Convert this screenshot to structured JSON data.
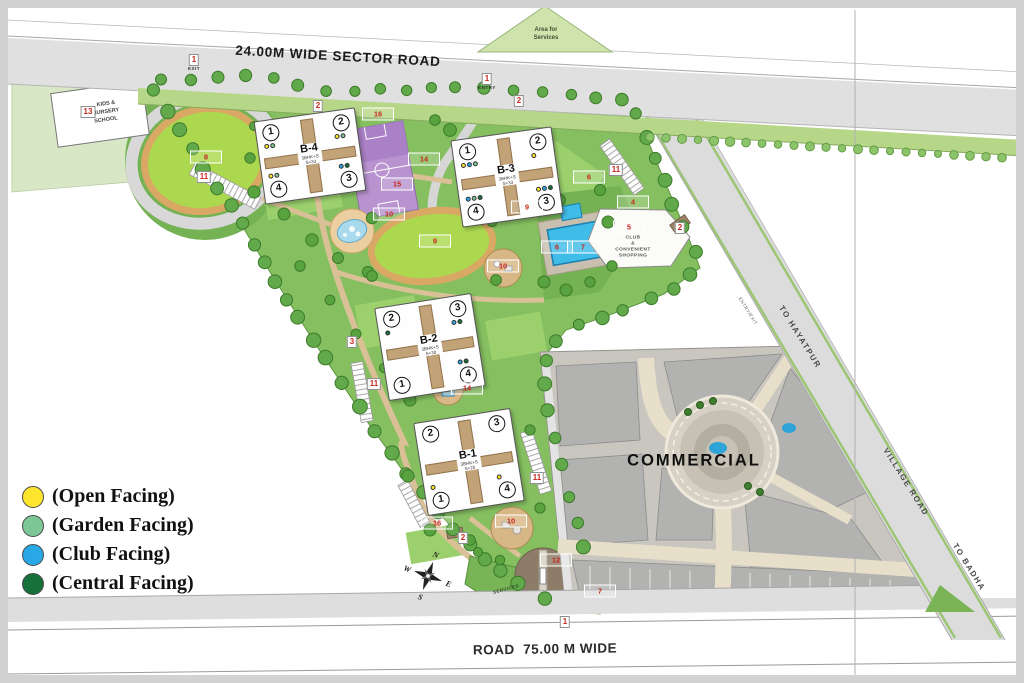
{
  "map": {
    "sector_road_label": "24.00M WIDE SECTOR ROAD",
    "bottom_road_label": "ROAD  75.00 M WIDE",
    "roads": {
      "to_hayatpur": "TO HAYATPUR",
      "village_road": "VILLAGE ROAD",
      "to_badha": "TO BADHA",
      "entry_exit": "ENTRY/EXIT"
    },
    "areas": {
      "commercial": "COMMERCIAL",
      "services_triangle": [
        "Area for",
        "Services"
      ],
      "services_patch": "SERVICES",
      "club": [
        "CLUB",
        "&",
        "CONVENIENT",
        "SHOPPING"
      ],
      "nursery": [
        "KIDS &",
        "NURSERY",
        "SCHOOL"
      ]
    },
    "compass": {
      "n": "N",
      "e": "E",
      "s": "S",
      "w": "W"
    },
    "legend_colors": {
      "open": "#ffe42e",
      "garden": "#7dc695",
      "club": "#29a8e6",
      "central": "#15703a"
    },
    "legend": {
      "items": [
        {
          "key": "open",
          "label": "(Open Facing)"
        },
        {
          "key": "garden",
          "label": "(Garden Facing)"
        },
        {
          "key": "club",
          "label": "(Club Facing)"
        },
        {
          "key": "central",
          "label": "(Central Facing)"
        }
      ]
    },
    "buildings": [
      {
        "name": "B-4",
        "sub1": "3BHK+S",
        "sub2": "S+33",
        "x": 310,
        "y": 156,
        "w": 100,
        "h": 82,
        "rot": -8,
        "towers": {
          "tl": {
            "n": "1",
            "dots": [
              "open",
              "garden"
            ]
          },
          "tr": {
            "n": "2",
            "dots": [
              "open",
              "garden"
            ]
          },
          "bl": {
            "n": "4",
            "dots": [
              "open",
              "garden"
            ]
          },
          "br": {
            "n": "3",
            "dots": [
              "club",
              "central"
            ]
          }
        }
      },
      {
        "name": "B-3",
        "sub1": "3BHK+S",
        "sub2": "S+33",
        "x": 507,
        "y": 177,
        "w": 100,
        "h": 86,
        "rot": -8,
        "towers": {
          "tl": {
            "n": "1",
            "dots": [
              "open",
              "club",
              "garden"
            ]
          },
          "tr": {
            "n": "2",
            "dots": [
              "open"
            ]
          },
          "bl": {
            "n": "4",
            "dots": [
              "club",
              "garden",
              "central"
            ]
          },
          "br": {
            "n": "3",
            "dots": [
              "open",
              "club",
              "central"
            ]
          }
        }
      },
      {
        "name": "B-2",
        "sub1": "3BHK+S",
        "sub2": "S+30",
        "x": 430,
        "y": 347,
        "w": 96,
        "h": 92,
        "rot": -9,
        "towers": {
          "tl": {
            "n": "2",
            "dots": [
              "central"
            ]
          },
          "tr": {
            "n": "3",
            "dots": [
              "club",
              "central"
            ]
          },
          "bl": {
            "n": "1",
            "dots": []
          },
          "br": {
            "n": "4",
            "dots": [
              "club",
              "central"
            ]
          }
        }
      },
      {
        "name": "B-1",
        "sub1": "3BHK+S",
        "sub2": "S+20",
        "x": 469,
        "y": 462,
        "w": 96,
        "h": 92,
        "rot": -9,
        "towers": {
          "tl": {
            "n": "2",
            "dots": []
          },
          "tr": {
            "n": "3",
            "dots": []
          },
          "bl": {
            "n": "1",
            "dots": [
              "open"
            ]
          },
          "br": {
            "n": "4",
            "dots": [
              "open"
            ]
          }
        }
      }
    ],
    "markers": [
      {
        "n": "1",
        "x": 194,
        "y": 60,
        "caption": "EXIT"
      },
      {
        "n": "1",
        "x": 487,
        "y": 79,
        "caption": "ENTRY"
      },
      {
        "n": "1",
        "x": 565,
        "y": 622
      },
      {
        "n": "2",
        "x": 318,
        "y": 106
      },
      {
        "n": "2",
        "x": 519,
        "y": 101
      },
      {
        "n": "2",
        "x": 680,
        "y": 228
      },
      {
        "n": "2",
        "x": 463,
        "y": 538
      },
      {
        "n": "3",
        "x": 352,
        "y": 342
      },
      {
        "n": "4",
        "x": 633,
        "y": 202
      },
      {
        "n": "5",
        "x": 629,
        "y": 227
      },
      {
        "n": "6",
        "x": 589,
        "y": 177
      },
      {
        "n": "6",
        "x": 557,
        "y": 247
      },
      {
        "n": "7",
        "x": 583,
        "y": 247
      },
      {
        "n": "7",
        "x": 600,
        "y": 591
      },
      {
        "n": "8",
        "x": 206,
        "y": 157
      },
      {
        "n": "9",
        "x": 435,
        "y": 241
      },
      {
        "n": "9",
        "x": 527,
        "y": 207
      },
      {
        "n": "10",
        "x": 389,
        "y": 214
      },
      {
        "n": "10",
        "x": 503,
        "y": 266
      },
      {
        "n": "10",
        "x": 511,
        "y": 521
      },
      {
        "n": "11",
        "x": 204,
        "y": 177
      },
      {
        "n": "11",
        "x": 616,
        "y": 170
      },
      {
        "n": "11",
        "x": 374,
        "y": 384
      },
      {
        "n": "11",
        "x": 537,
        "y": 478
      },
      {
        "n": "12",
        "x": 556,
        "y": 560
      },
      {
        "n": "13",
        "x": 88,
        "y": 112
      },
      {
        "n": "14",
        "x": 424,
        "y": 159
      },
      {
        "n": "14",
        "x": 467,
        "y": 388
      },
      {
        "n": "15",
        "x": 397,
        "y": 184
      },
      {
        "n": "16",
        "x": 378,
        "y": 114
      },
      {
        "n": "16",
        "x": 437,
        "y": 523
      }
    ]
  }
}
